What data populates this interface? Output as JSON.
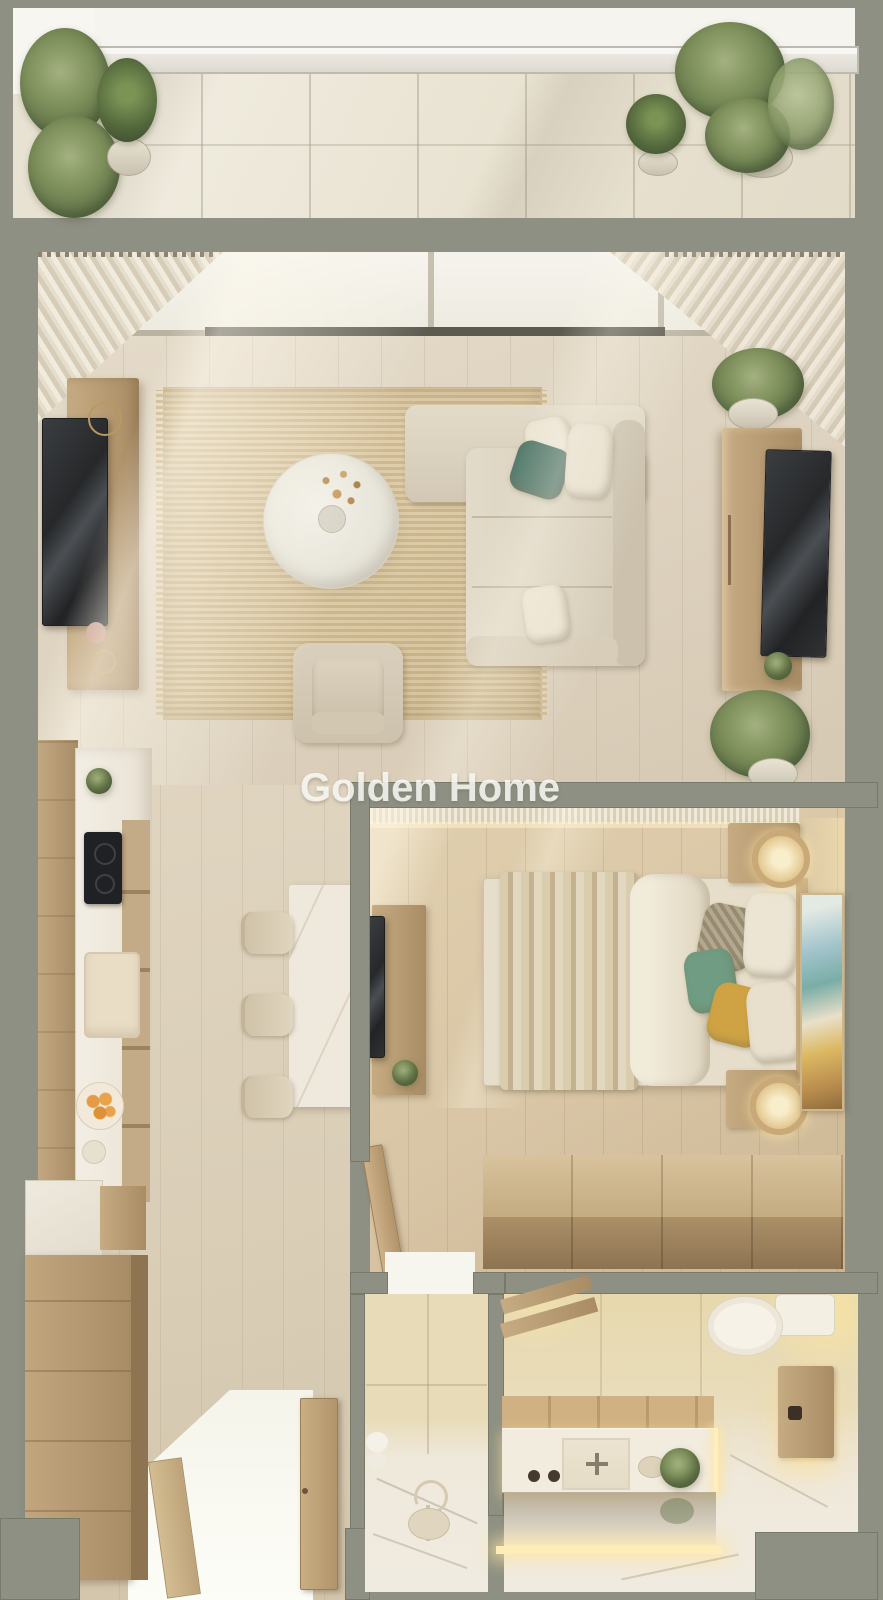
{
  "watermark": {
    "text": "Golden Home"
  },
  "palette": {
    "wall": "#8d9083",
    "wood_light": "#c6ab83",
    "wood_dark": "#8f7452",
    "floor_living": "#ded3c0",
    "floor_bedroom": "#d8c5a5",
    "rug": "#d8c49c",
    "sofa": "#ddd4c2",
    "pillow_teal": "#547a6c",
    "pillow_green": "#6f9c82",
    "pillow_mustard": "#cfa344",
    "marble": "#efe9dd",
    "bath_glow": "#ffe9ae",
    "plant_green": "#7d8f5a",
    "tv_screen": "#2e3032",
    "orange_fruit": "#e59a45",
    "entry_light": "#fbfbf4"
  },
  "rooms": {
    "balcony": {
      "label": "Balcony terrace",
      "items": [
        "glass railing",
        "potted olive trees",
        "agave plant",
        "round shrub",
        "stone tile floor"
      ]
    },
    "living_room": {
      "label": "Living room",
      "items": [
        "sliding glass doors",
        "sheer curtains",
        "wall-mounted TV",
        "media board",
        "jute rug",
        "round marble coffee table",
        "dried flower vase",
        "L-shaped sectional sofa",
        "throw pillows",
        "lounge armchair",
        "TV sideboard",
        "potted plants"
      ]
    },
    "kitchen": {
      "label": "Kitchen",
      "items": [
        "wood cabinets",
        "marble counter",
        "cooktop",
        "sink",
        "fruit bowl",
        "open shelving"
      ]
    },
    "dining": {
      "label": "Dining nook",
      "items": [
        "marble dining table",
        "three upholstered stools"
      ]
    },
    "bedroom": {
      "label": "Bedroom",
      "items": [
        "double bed",
        "layered blanket",
        "duvet",
        "accent pillows",
        "two nightstands",
        "rattan pendant lamps",
        "abstract wall art",
        "TV console desk",
        "storage chest bench",
        "curtain wall"
      ]
    },
    "hallway": {
      "label": "Entry hall",
      "items": [
        "tall drawer dresser",
        "marble shelf",
        "wood bench",
        "open door",
        "daylight entry glow"
      ]
    },
    "bathroom": {
      "label": "Bathroom",
      "items": [
        "walk-in shower room",
        "shower stool",
        "toilet",
        "floating wood vanity",
        "marble washbasin",
        "LED strip lighting",
        "wood cabinet",
        "ladder shelf",
        "potted plant"
      ]
    }
  }
}
